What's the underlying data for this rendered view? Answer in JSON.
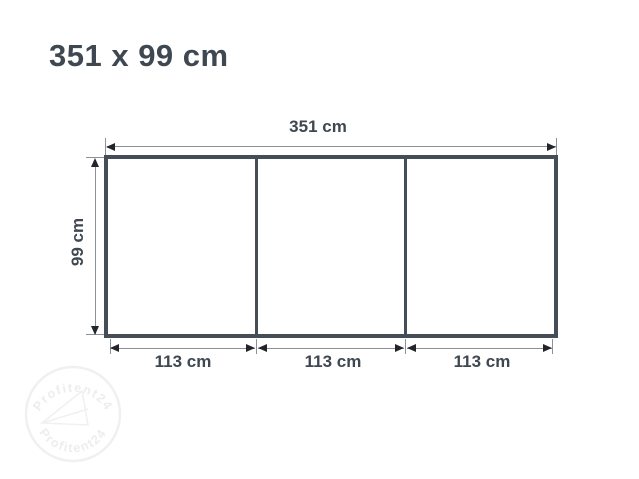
{
  "title": "351 x 99 cm",
  "diagram": {
    "total_width_label": "351 cm",
    "height_label": "99 cm",
    "segments": [
      "113 cm",
      "113 cm",
      "113 cm"
    ],
    "panel_count": 3
  },
  "watermark": {
    "text_top": "Profitent24",
    "text_bottom": "Profitent24"
  },
  "colors": {
    "text": "#3f4851",
    "frame_border": "#454d56",
    "dimension_line": "#8b9197",
    "arrowhead": "#22262b",
    "watermark": "#f0f0f0",
    "background": "#ffffff"
  }
}
